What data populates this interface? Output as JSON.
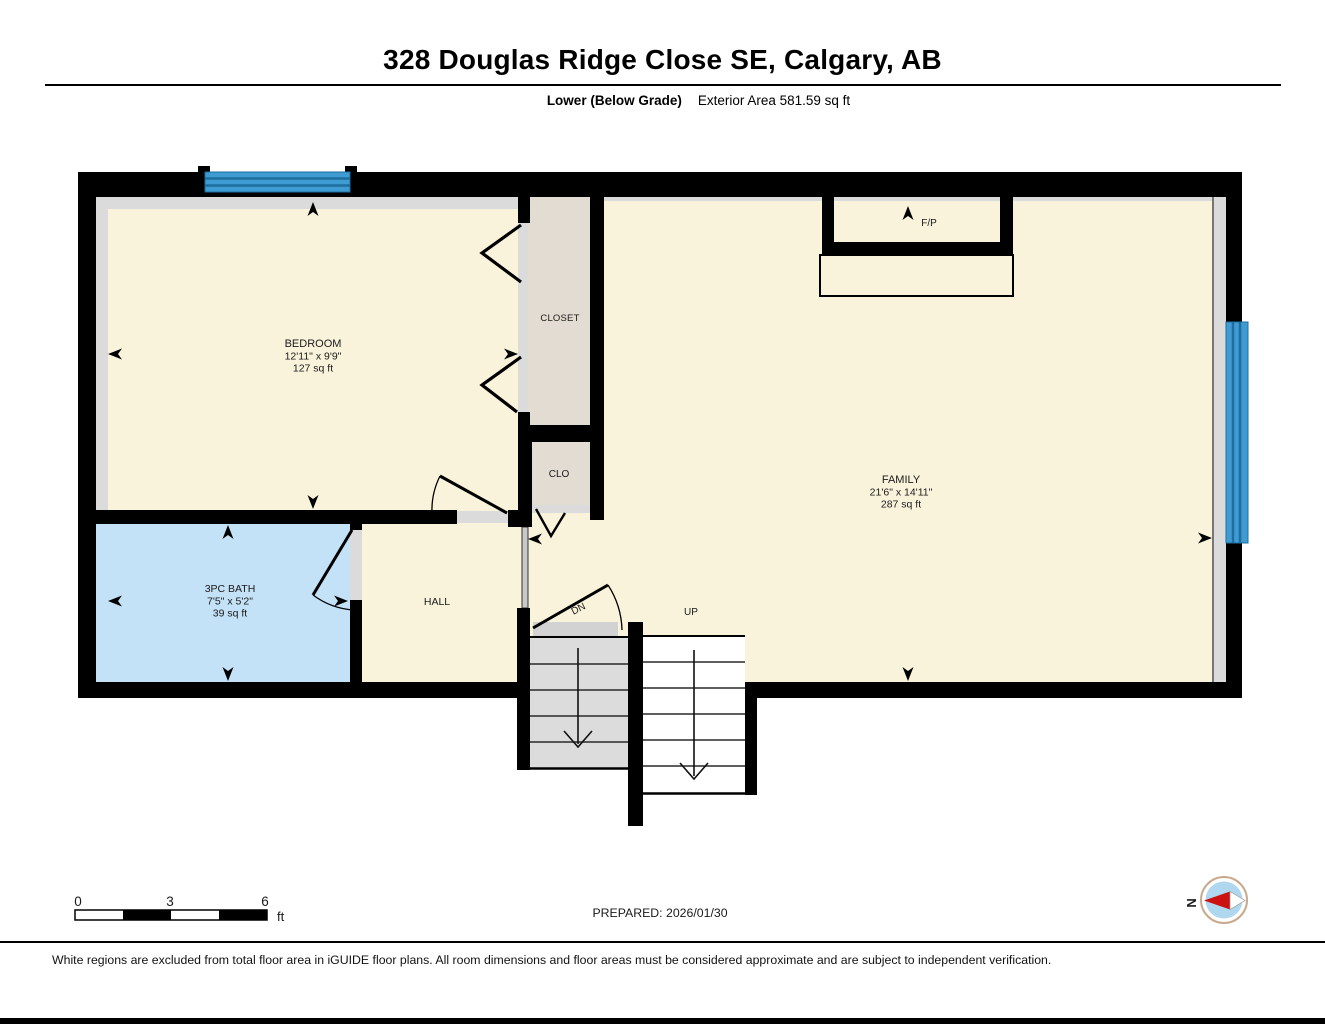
{
  "header": {
    "title": "328 Douglas Ridge Close SE, Calgary, AB",
    "floor_label": "Lower (Below Grade)",
    "area_label": "Exterior Area 581.59 sq ft"
  },
  "rooms": {
    "bedroom": {
      "name": "BEDROOM",
      "dims": "12'11\" x 9'9\"",
      "area": "127 sq ft"
    },
    "family": {
      "name": "FAMILY",
      "dims": "21'6\" x 14'11\"",
      "area": "287 sq ft"
    },
    "bath": {
      "name": "3PC BATH",
      "dims": "7'5\" x 5'2\"",
      "area": "39 sq ft"
    },
    "hall": {
      "name": "HALL"
    },
    "closet": {
      "name": "CLOSET"
    },
    "clo": {
      "name": "CLO"
    },
    "fireplace": {
      "name": "F/P"
    }
  },
  "stairs": {
    "down_label": "DN",
    "up_label": "UP"
  },
  "scale_bar": {
    "ticks": [
      "0",
      "3",
      "6"
    ],
    "unit": "ft"
  },
  "prepared_label": "PREPARED: 2026/01/30",
  "compass": {
    "north_label": "N"
  },
  "footer_note": "White regions are excluded from total floor area in iGUIDE floor plans. All room dimensions and floor areas must be considered approximate and are subject to independent verification.",
  "colors": {
    "room_fill": "#FAF3DB",
    "bath_fill": "#C4E2F7",
    "closet_fill": "#E3DCD2",
    "window_blue": "#3E9CD2",
    "window_stripe": "#1F6E9E",
    "wall": "#000000",
    "trim_gray": "#DBDBDB",
    "stair_gray": "#DCDCDC",
    "landing_gray": "#D2D2D2",
    "compass_blue": "#AFD7EF",
    "compass_ring": "#C8A98E",
    "compass_red": "#CC1111"
  }
}
